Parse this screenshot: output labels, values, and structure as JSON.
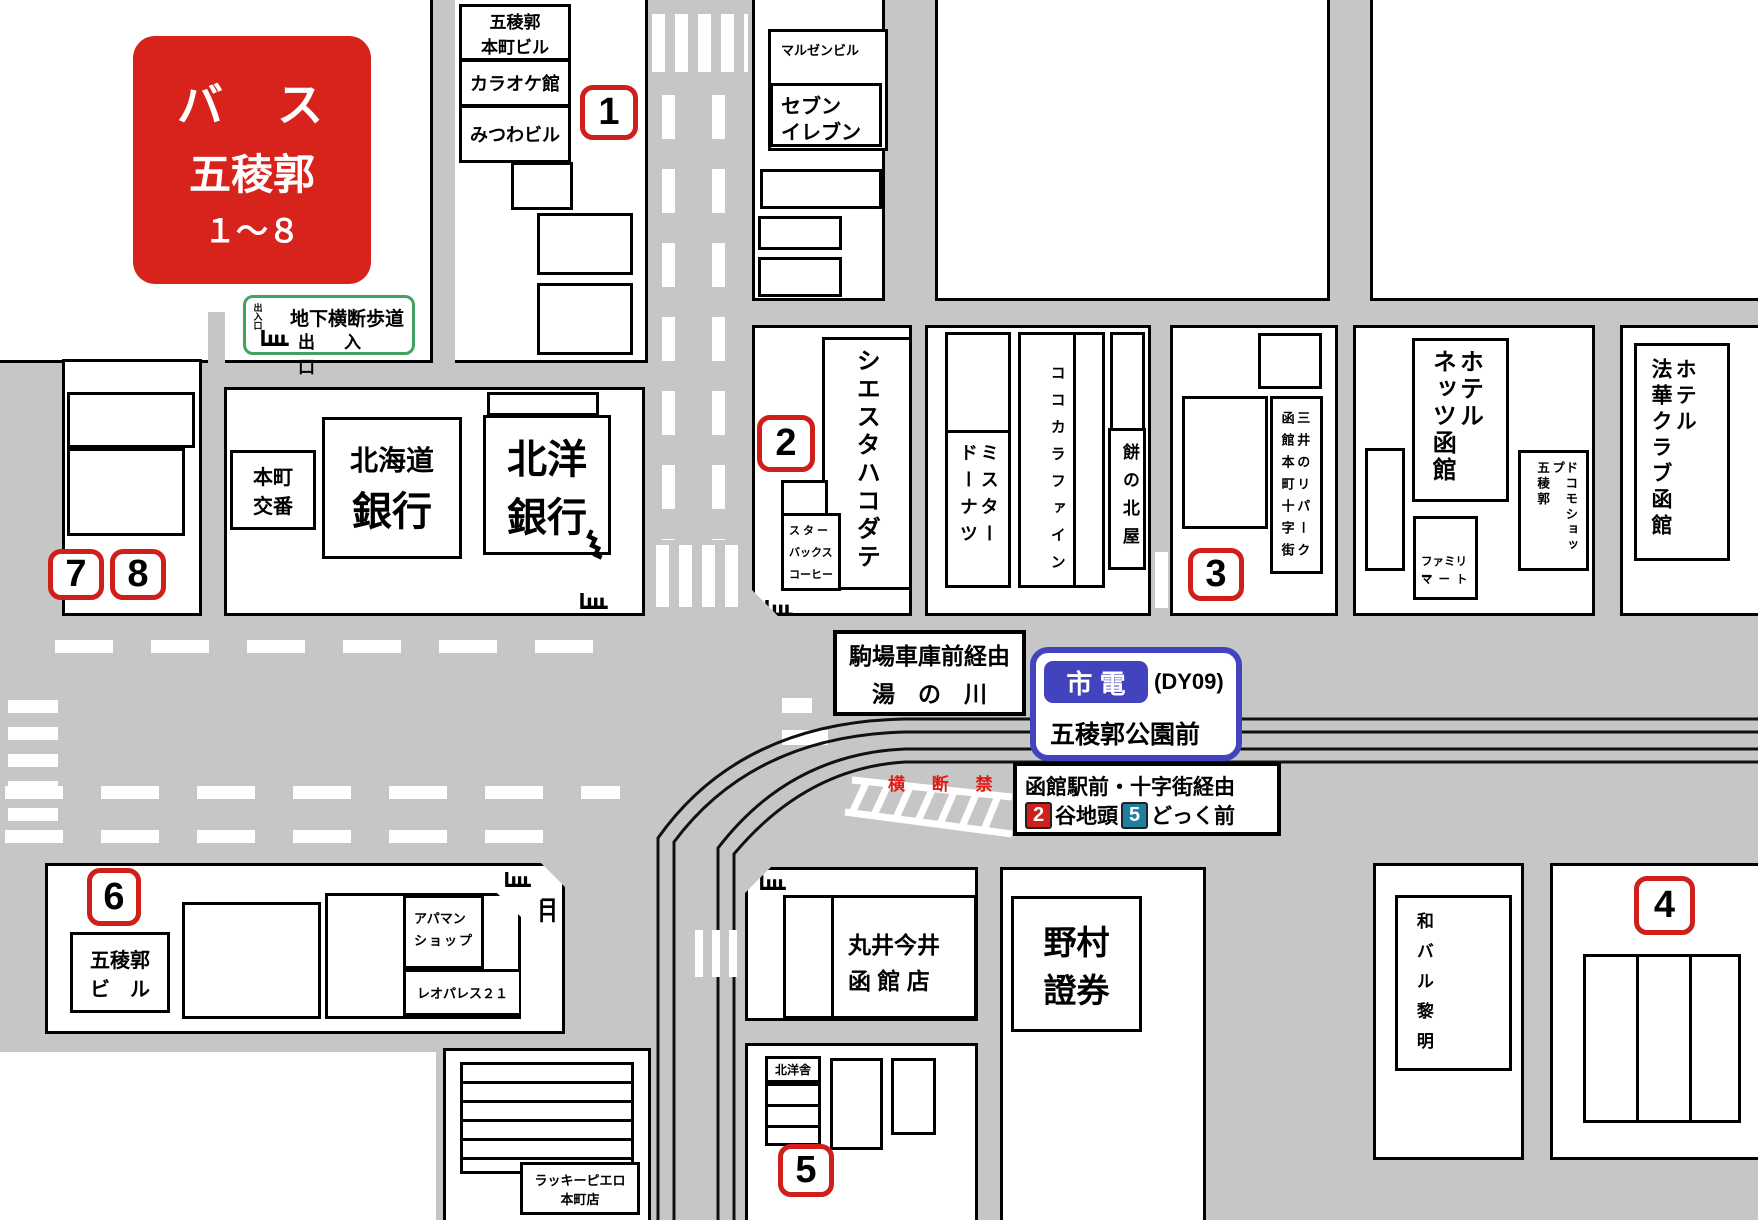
{
  "colors": {
    "road": "#c6c6c6",
    "block_fill": "#ffffff",
    "line": "#000000",
    "sign_red": "#d8231c",
    "stop_red": "#cf1f1a",
    "green": "#3fa45f",
    "tram_blue": "#4343bd",
    "badge_teal": "#1f7f9f",
    "warn_red": "#e01a14"
  },
  "bus_sign": {
    "line1": "バ　ス",
    "line2": "五稜郭",
    "line3": "１～８"
  },
  "underpass_sign": {
    "side": "出入口",
    "title": "地下横断歩道",
    "subtitle": "出　入　口"
  },
  "stops": {
    "s1": "1",
    "s2": "2",
    "s3": "3",
    "s4": "4",
    "s5": "5",
    "s6": "6",
    "s7": "7",
    "s8": "8"
  },
  "tram_sign": {
    "badge": "市 電",
    "code": "(DY09)",
    "name": "五稜郭公園前"
  },
  "yunokawa_sign": {
    "line1": "駒場車庫前経由",
    "line2": "湯　の　川"
  },
  "hakodate_sign": {
    "line1": "函館駅前・十字街経由",
    "badge2": "2",
    "dest2": "谷地頭",
    "badge5": "5",
    "dest5": "どっく前"
  },
  "no_crossing": "横 断 禁 止",
  "buildings": {
    "goryokaku_honcho": [
      "五稜郭",
      "本町ビル"
    ],
    "karaoke": "カラオケ館",
    "mitsuwa": "みつわビル",
    "maruzen": "マルゼンビル",
    "seven": [
      "セブン",
      "イレブン"
    ],
    "koban": [
      "本町",
      "交番"
    ],
    "hokkaido_bank": [
      "北海道",
      "銀行"
    ],
    "hokuyo_bank": [
      "北洋",
      "銀行"
    ],
    "siesta": "シエスタハコダテ",
    "starbucks": [
      "スター",
      "バックス",
      "コーヒー"
    ],
    "mister_donut": [
      "ミスター",
      "ドーナツ"
    ],
    "cocokara": "ココカラファイン",
    "mochi": "餅の北屋",
    "mitsui_repark": [
      "三井のリパーク",
      "函館本町十字街"
    ],
    "hotel_nets": [
      "ホテル",
      "ネッツ函館"
    ],
    "familymart": [
      "ファミリー",
      "マート"
    ],
    "docomo": [
      "ドコモショップ",
      "五稜郭"
    ],
    "hotel_hokke": [
      "ホテル",
      "法華クラブ函館"
    ],
    "goryokaku_bldg": [
      "五稜郭",
      "ビ　ル"
    ],
    "apaman": [
      "アパマン",
      "ショップ"
    ],
    "leopalace": "レオパレス２１",
    "lucky_pierrot": [
      "ラッキーピエロ",
      "本町店"
    ],
    "marui_imai": [
      "丸井今井",
      "函 館 店"
    ],
    "nomura": [
      "野村",
      "證券"
    ],
    "hokuyosha": "北洋舎",
    "wabaru": "和バル黎明"
  }
}
